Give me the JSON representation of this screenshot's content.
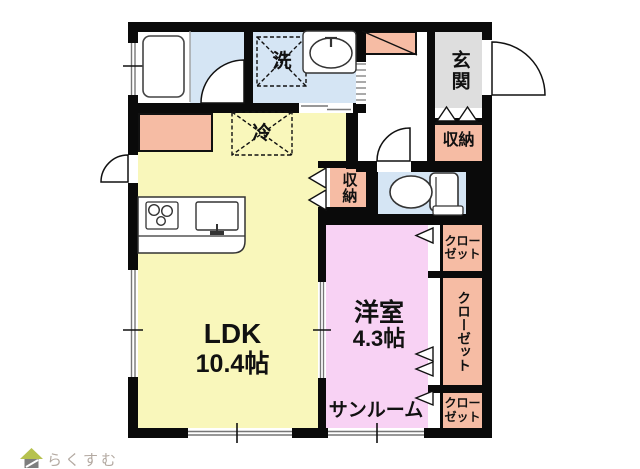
{
  "plan": {
    "rooms": {
      "ldk": {
        "label": "LDK",
        "size": "10.4帖"
      },
      "western_room": {
        "label": "洋室",
        "size": "4.3帖"
      },
      "sunroom": {
        "label": "サンルーム"
      },
      "entrance": {
        "label": "玄関"
      },
      "entrance_storage": {
        "label": "収納"
      },
      "hall_storage": {
        "label": "収納"
      },
      "closet_top": {
        "label": "クロー\nゼット"
      },
      "closet_middle": {
        "label": "クローゼット"
      },
      "closet_bottom": {
        "label": "クロー\nゼット"
      }
    },
    "fixtures": {
      "washing_machine_label": "洗",
      "refrigerator_label": "冷"
    },
    "colors": {
      "ldk_floor": "#f9f7bb",
      "western_room_floor": "#f8d2f4",
      "storage_fill": "#f6bca4",
      "wet_area_floor": "#d5e5f4",
      "entrance_floor": "#dedede",
      "wall": "#0a0a0a",
      "logo_roof_green": "#b6c24f",
      "logo_body_gray": "#7e7e7e",
      "logo_text_color": "#b3a9a1"
    }
  },
  "logo": {
    "text": "らくすむ"
  }
}
